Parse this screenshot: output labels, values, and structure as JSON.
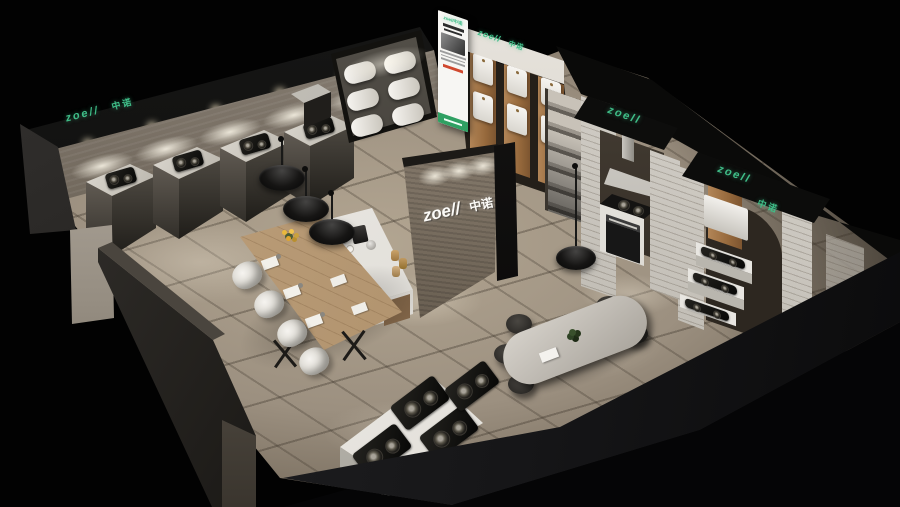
{
  "scene": {
    "type": "3d-render",
    "subject": "Kitchen appliance brand showroom interior, isometric aerial view",
    "brand": {
      "latin": "zoell",
      "cjk": "中诺"
    }
  },
  "signs": {
    "left_wall": {
      "latin": "zoe//",
      "cjk": "中诺"
    },
    "heater_wall": {
      "latin": "zoell",
      "cjk": "中诺"
    },
    "poster": {
      "latin": "zoell",
      "cjk": "中诺"
    },
    "feature_wall": {
      "latin": "zoe//",
      "cjk": "中诺"
    },
    "alcove_one": {
      "latin": "zoell"
    },
    "alcove_two": {
      "latin": "zoell",
      "cjk": "中诺"
    }
  },
  "palette": {
    "brand_green": "#3fbd88",
    "floor_tile": "#a3988a",
    "wood_panel": "#ab8257",
    "table_wood": "#b3946f",
    "brick_white": "#d6d2cb",
    "background": "#000000"
  },
  "inventory": {
    "cooktop_display_stands": 4,
    "hood_display_cylinders": 6,
    "wall_water_heaters": 6,
    "island_cooktops": 4,
    "white_dining_chairs": 4,
    "dark_meeting_chairs": 5,
    "pendant_lamps": 4,
    "kitchen_alcoves": 2
  }
}
